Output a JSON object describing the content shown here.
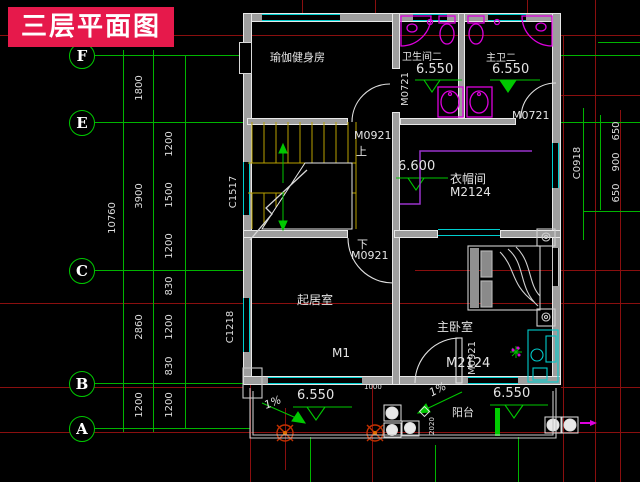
{
  "title": {
    "label": "三层平面图"
  },
  "colors": {
    "banner_red": "#e6194b",
    "grid_green": "#00b400",
    "axis_red": "#8a0f0f",
    "wall_gray": "#9e9e9e",
    "window_cyan": "#00cfcf",
    "fixture_magenta": "#dd00dd",
    "stair_yellow": "#b8a000",
    "text_white": "#e4e4e4"
  },
  "grid_bubbles": [
    "F",
    "E",
    "C",
    "B",
    "A"
  ],
  "dims": {
    "overall": "10760",
    "major": [
      "1800",
      "3900",
      "2860",
      "1200"
    ],
    "minor": [
      "1200",
      "1500",
      "1200",
      "830",
      "1200",
      "830",
      "1200"
    ],
    "right": [
      "650",
      "900",
      "650"
    ],
    "misc": [
      "1000",
      "2020"
    ]
  },
  "rooms": {
    "yoga": "瑜伽健身房",
    "bath": "卫生间二",
    "bath_level": "6.550",
    "master_bath": "主卫二",
    "master_bath_level": "6.550",
    "closet": "衣帽间",
    "living": "起居室",
    "bedroom": "主卧室",
    "balcony": "阳台"
  },
  "levels": {
    "stair": "6.600",
    "balcony_left": "6.550",
    "balcony_right": "6.550"
  },
  "slopes": [
    "1%",
    "1%"
  ],
  "stair": {
    "up": "上",
    "down": "下"
  },
  "openings": {
    "m0721_hall": "M0721",
    "m0721_closet": "M0721",
    "m0921_stair_top": "M0921",
    "m0921_stair_bottom": "M0921",
    "m0921_bedroom": "M0921",
    "m2124_closet": "M2124",
    "m2124_bedroom": "M2124",
    "m1": "M1",
    "c1517": "C1517",
    "c1218": "C1218",
    "c0918": "C0918"
  }
}
